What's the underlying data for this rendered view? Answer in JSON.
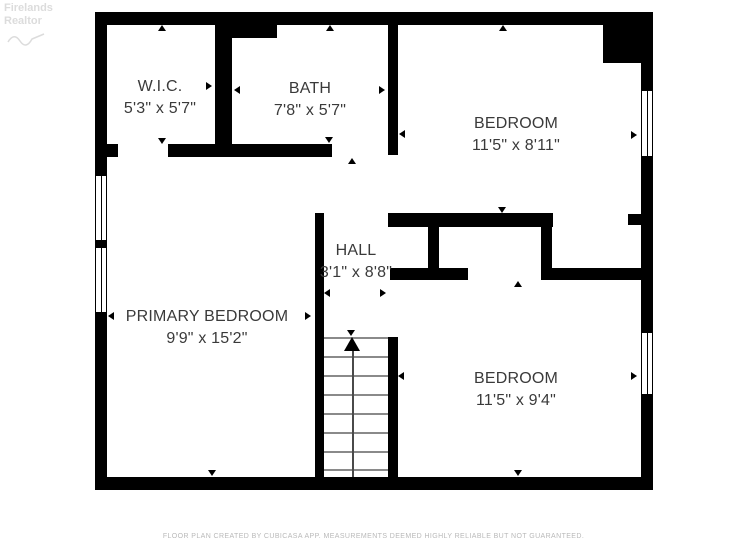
{
  "watermark": {
    "line1": "Firelands",
    "line2": "Realtor"
  },
  "rooms": [
    {
      "id": "wic",
      "name": "W.I.C.",
      "dims": "5'3\" x 5'7\""
    },
    {
      "id": "bath",
      "name": "BATH",
      "dims": "7'8\" x 5'7\""
    },
    {
      "id": "bedroom-top",
      "name": "BEDROOM",
      "dims": "11'5\" x 8'11\""
    },
    {
      "id": "hall",
      "name": "HALL",
      "dims": "3'1\" x 8'8\""
    },
    {
      "id": "primary-bedroom",
      "name": "PRIMARY BEDROOM",
      "dims": "9'9\" x 15'2\""
    },
    {
      "id": "bedroom-bottom",
      "name": "BEDROOM",
      "dims": "11'5\" x 9'4\""
    }
  ],
  "footer": {
    "text": "FLOOR PLAN CREATED BY CUBICASA APP. MEASUREMENTS DEEMED HIGHLY RELIABLE BUT NOT GUARANTEED."
  },
  "colors": {
    "wall": "#000000",
    "label_text": "#3a3a3a",
    "footer_text": "#b9b9b9",
    "watermark_text": "#dcdcdc",
    "stair_tread": "#8a8a8a"
  }
}
